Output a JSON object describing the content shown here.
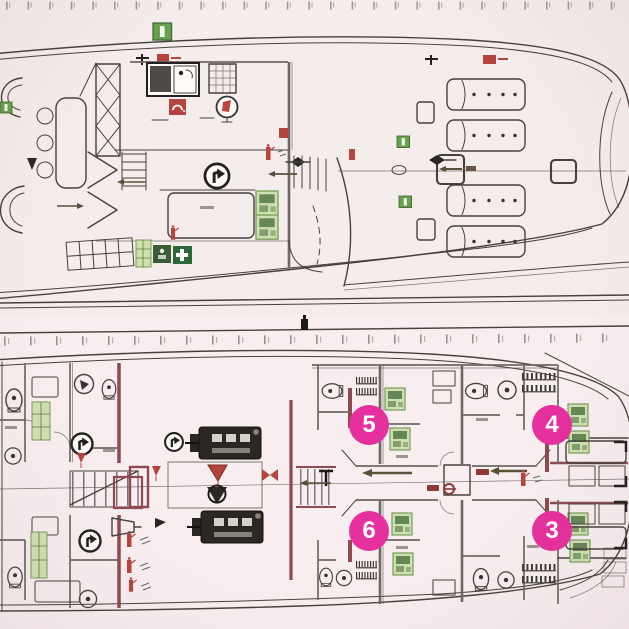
{
  "plan": {
    "type": "yacht-safety-deck-plans",
    "deck_count": 2,
    "decks": [
      {
        "name": "upper-deck-plan"
      },
      {
        "name": "lower-deck-plan"
      }
    ]
  },
  "markers": [
    {
      "label": "5"
    },
    {
      "label": "4"
    },
    {
      "label": "6"
    },
    {
      "label": "3"
    }
  ],
  "colors": {
    "paper": "#f5edeb",
    "paper_lower": "#f8eef0",
    "line": "#46413d",
    "wall": "#6e6762",
    "maroon": "#8e4a50",
    "red": "#b5443c",
    "green": "#68a04e",
    "green_light": "#cfe0b0",
    "green_dark": "#42683a",
    "olive": "#565238",
    "equipment": "#2b2823",
    "marker_bg": "#e6309d",
    "marker_text": "#ffffff"
  }
}
